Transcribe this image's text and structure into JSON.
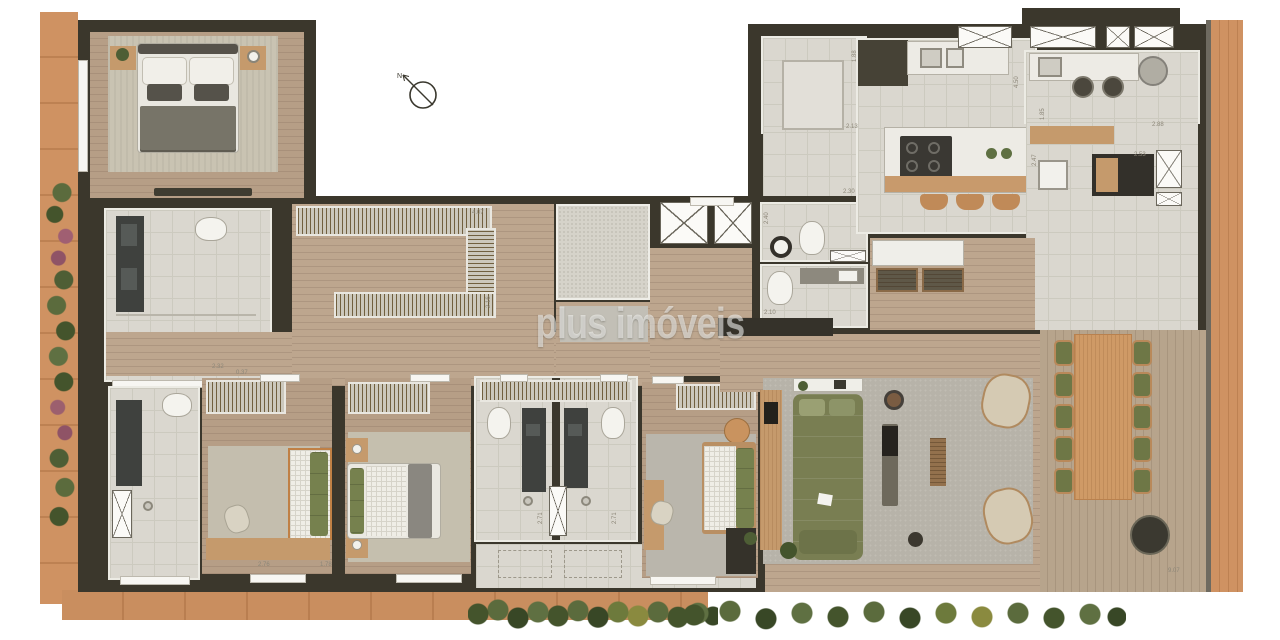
{
  "watermark": {
    "text": "plus imóveis"
  },
  "compass": {
    "label": "N"
  },
  "dims": {
    "d1": "4.07",
    "d2": "2.16",
    "d3": "1.88",
    "d4": "2.13",
    "d5": "2.30",
    "d6": "4.50",
    "d7": "1.85",
    "d8": "2.88",
    "d9": "2.53",
    "d10": "2.47",
    "d11": "2.40",
    "d12": "2.10",
    "d13": "2.32",
    "d14": "0.37",
    "d15": "2.76",
    "d16": "1.78",
    "d17": "2.71",
    "d18": "2.71",
    "d19": "9.07"
  },
  "colors": {
    "wall": "#3b372c",
    "wood_floor": "#b49c85",
    "terrace_deck": "#b3a089",
    "border_wood": "#cd9161",
    "tile": "#dad7cf",
    "sofa_green": "#7d8257",
    "chair_green": "#6e7746",
    "dining_wood": "#cf9a66",
    "rug_gray": "#b5b1a7",
    "plant_green": "#54663a",
    "flower_pink": "#9c5f6e"
  }
}
